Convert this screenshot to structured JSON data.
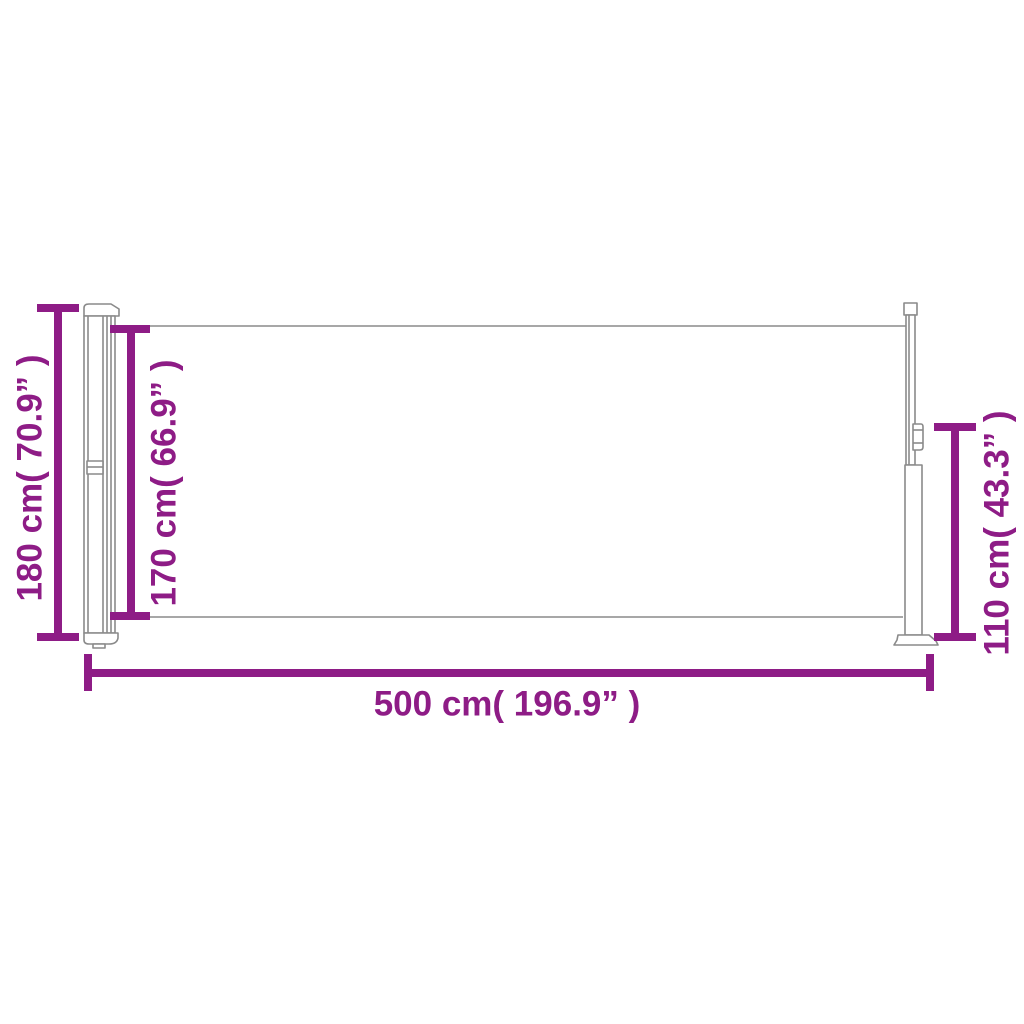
{
  "colors": {
    "background": "#ffffff",
    "dimension_lines": "#8E1C86",
    "structure_lines": "#8A8A8A"
  },
  "diagram": {
    "dimensions": {
      "total_height": {
        "label": "180 cm( 70.9” )"
      },
      "fabric_height": {
        "label": "170 cm( 66.9” )"
      },
      "post_height": {
        "label": "110 cm( 43.3” )"
      },
      "total_width": {
        "label": "500 cm( 196.9” )"
      }
    }
  }
}
